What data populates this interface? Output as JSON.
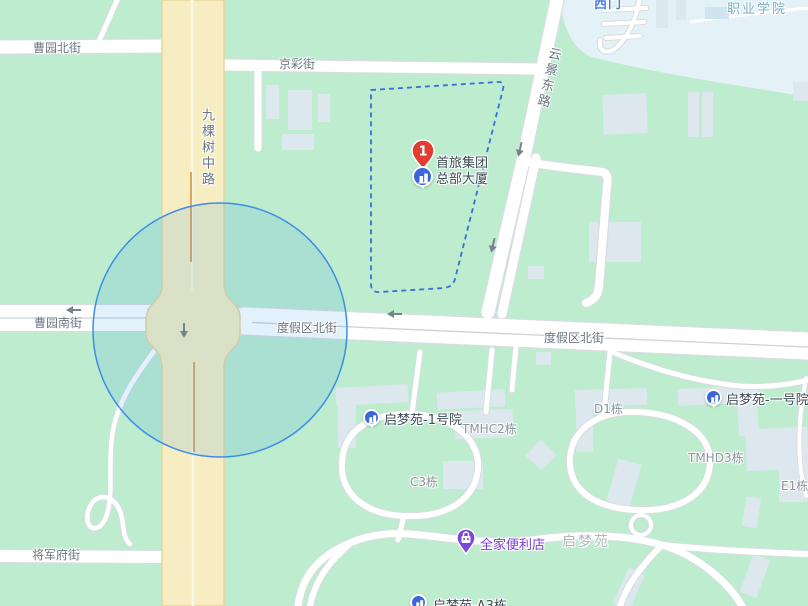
{
  "colors": {
    "marker_red": "#e23b30",
    "poi_blue": "#3a66d9",
    "poi_purple": "#7b49da",
    "selection_dash_blue": "#3a6fd8",
    "radius_circle_blue": "#3d8de8",
    "map_green": "#bdeccf",
    "campus_light_blue": "#e4f1f6",
    "road_yellow": "#f6edc3"
  },
  "marker": {
    "rank": "1",
    "label_line1": "首旅集团",
    "label_line2": "总部大厦"
  },
  "streets": [
    {
      "label": "曹园北街"
    },
    {
      "label": "京彩街"
    },
    {
      "label": "九棵树中路"
    },
    {
      "label": "云景东路"
    },
    {
      "label": "曹园南街"
    },
    {
      "label": "度假区北街"
    },
    {
      "label": "度假区北街"
    },
    {
      "label": "将军府街"
    }
  ],
  "pois": [
    {
      "label": "启梦苑-1号院"
    },
    {
      "label": "启梦苑-一号院"
    },
    {
      "label": "全家便利店"
    },
    {
      "label": "启梦苑-A3栋"
    }
  ],
  "building_labels": [
    {
      "label": "TMHC2栋"
    },
    {
      "label": "C3栋"
    },
    {
      "label": "D1栋"
    },
    {
      "label": "TMHD3栋"
    },
    {
      "label": "E1栋"
    }
  ],
  "area_labels": [
    {
      "label": "启梦苑"
    },
    {
      "label": "西门"
    },
    {
      "label": "职业学院"
    }
  ]
}
